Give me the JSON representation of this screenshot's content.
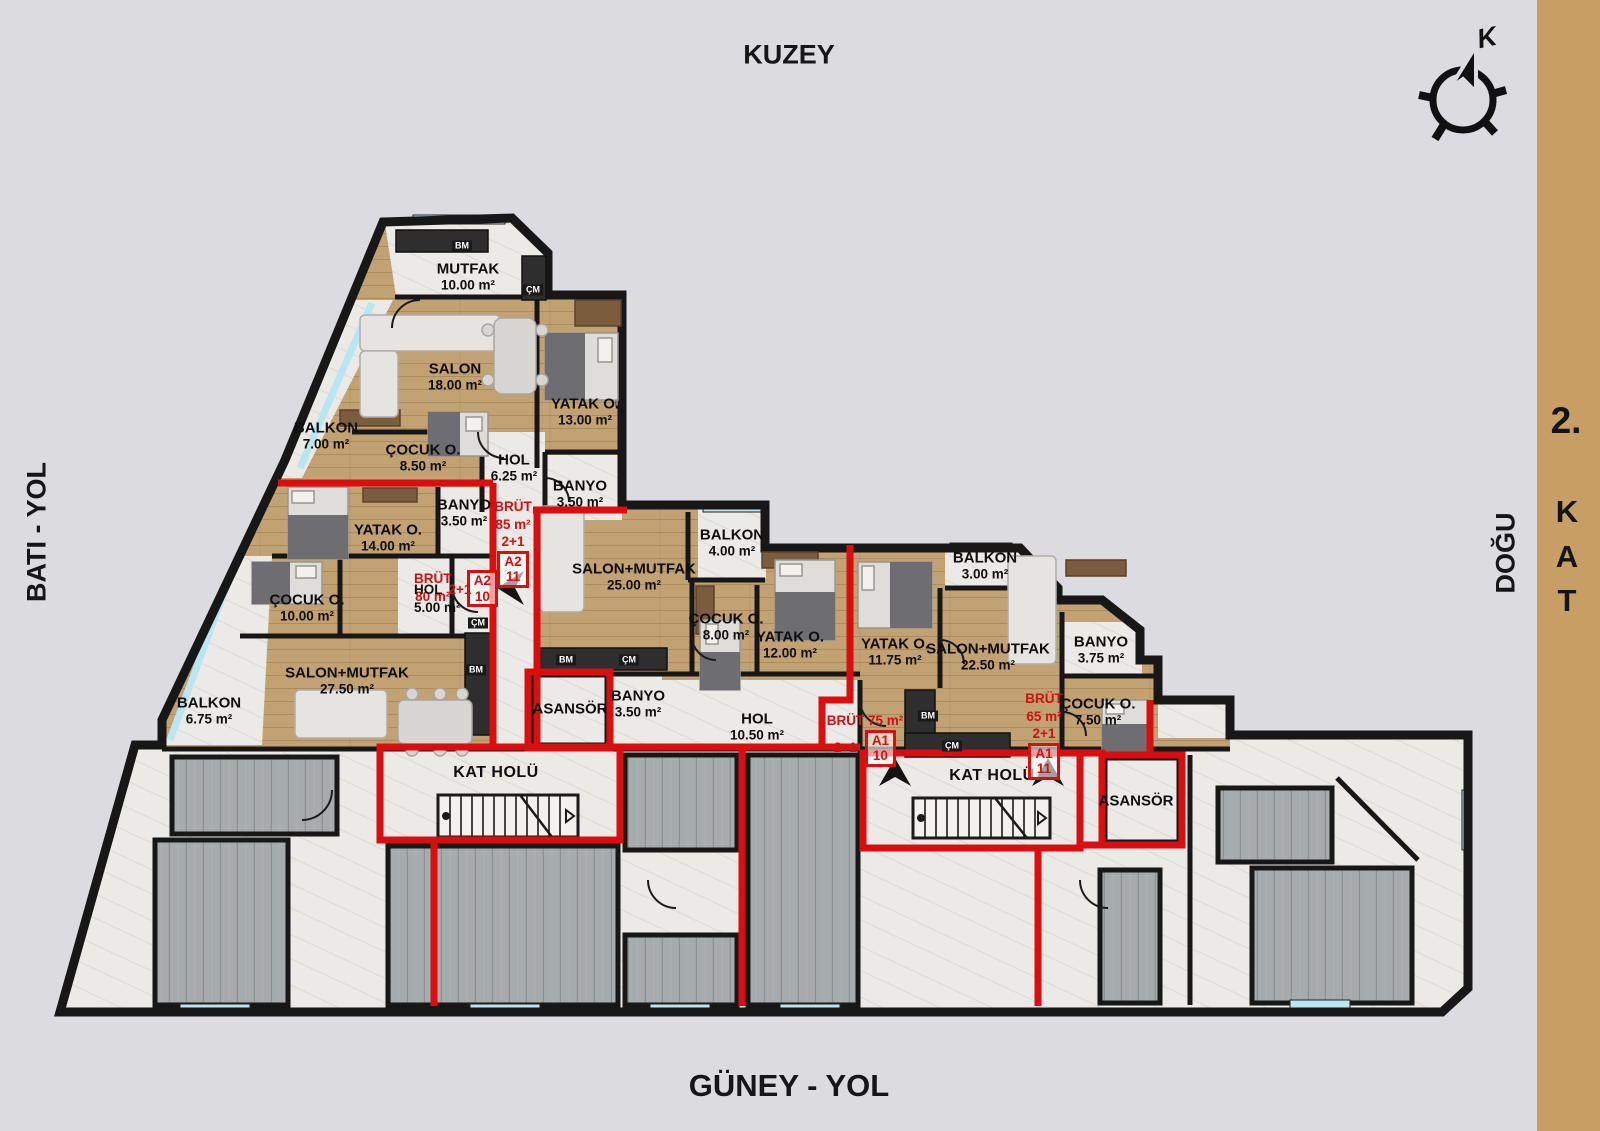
{
  "colors": {
    "background": "#dcdbe0",
    "side_band": "#c79e63",
    "unit_outline_red": "#d90f0f",
    "wood_floor": "#c2a173",
    "marble_floor": "#eceae6",
    "gray_floor": "#a6abad",
    "wall": "#171717",
    "window_glass": "#b9e6f2"
  },
  "compass": {
    "letter": "K"
  },
  "directions": {
    "north": "KUZEY",
    "south": "GÜNEY - YOL",
    "west": "BATI - YOL",
    "east": "DOĞU"
  },
  "floor": {
    "number": "2.",
    "letters": [
      "K",
      "A",
      "T"
    ]
  },
  "rooms": [
    {
      "name": "MUTFAK",
      "area": "10.00 m²"
    },
    {
      "name": "SALON",
      "area": "18.00 m²"
    },
    {
      "name": "YATAK O.",
      "area": "13.00 m²"
    },
    {
      "name": "BALKON",
      "area": "7.00 m²"
    },
    {
      "name": "ÇOCUK O.",
      "area": "8.50 m²"
    },
    {
      "name": "HOL",
      "area": "6.25 m²"
    },
    {
      "name": "BANYO",
      "area": "3.50 m²"
    },
    {
      "name": "YATAK O.",
      "area": "14.00 m²"
    },
    {
      "name": "BANYO",
      "area": "3.50 m²"
    },
    {
      "name": "ÇOCUK O.",
      "area": "10.00 m²"
    },
    {
      "name": "HOL",
      "area": "5.00 m²"
    },
    {
      "name": "SALON+MUTFAK",
      "area": "27.50 m²"
    },
    {
      "name": "BALKON",
      "area": "6.75 m²"
    },
    {
      "name": "SALON+MUTFAK",
      "area": "25.00 m²"
    },
    {
      "name": "BALKON",
      "area": "4.00 m²"
    },
    {
      "name": "ÇOCUK O.",
      "area": "8.00 m²"
    },
    {
      "name": "YATAK O.",
      "area": "12.00 m²"
    },
    {
      "name": "BANYO",
      "area": "3.50 m²"
    },
    {
      "name": "ASANSÖR",
      "area": ""
    },
    {
      "name": "HOL",
      "area": "10.50 m²"
    },
    {
      "name": "KAT HOLÜ",
      "area": ""
    },
    {
      "name": "YATAK O.",
      "area": "11.75 m²"
    },
    {
      "name": "BALKON",
      "area": "3.00 m²"
    },
    {
      "name": "SALON+MUTFAK",
      "area": "22.50 m²"
    },
    {
      "name": "BANYO",
      "area": "3.75 m²"
    },
    {
      "name": "ÇOCUK O.",
      "area": "7.50 m²"
    },
    {
      "name": "KAT HOLÜ",
      "area": ""
    },
    {
      "name": "ASANSÖR",
      "area": ""
    }
  ],
  "units": [
    {
      "brut": "BRÜT",
      "size": "85 m²",
      "type": "2+1",
      "block": "A2",
      "no": "11"
    },
    {
      "brut": "BRÜT",
      "size": "80 m²",
      "type": "2+1",
      "block": "A2",
      "no": "10"
    },
    {
      "brut": "BRÜT 75 m²",
      "size": "",
      "type": "2+1",
      "block": "A1",
      "no": "10"
    },
    {
      "brut": "BRÜT",
      "size": "65 m²",
      "type": "2+1",
      "block": "A1",
      "no": "11"
    }
  ],
  "fixtures": [
    {
      "label": "BM"
    },
    {
      "label": "ÇM"
    },
    {
      "label": "ÇM"
    },
    {
      "label": "BM"
    },
    {
      "label": "BM"
    },
    {
      "label": "ÇM"
    },
    {
      "label": "BM"
    },
    {
      "label": "ÇM"
    }
  ]
}
